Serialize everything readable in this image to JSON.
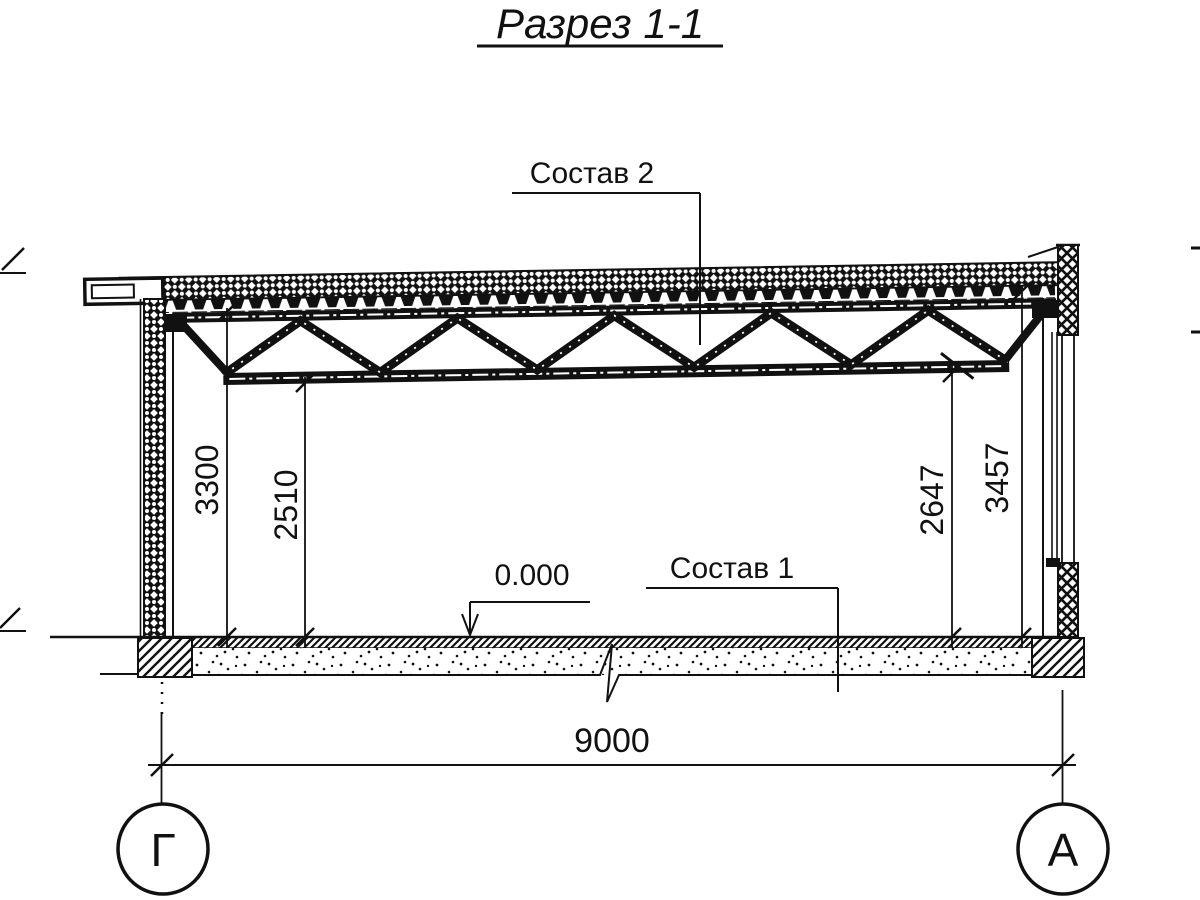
{
  "title": "Разрез 1-1",
  "colors": {
    "ink": "#111111",
    "background": "#ffffff"
  },
  "callouts": {
    "roof_assembly": "Состав 2",
    "floor_assembly": "Состав 1",
    "floor_level": "0.000"
  },
  "dimensions": {
    "left_outer": "3300",
    "left_inner": "2510",
    "right_inner": "2647",
    "right_outer": "3457",
    "span": "9000"
  },
  "axes": {
    "left": "Г",
    "right": "А"
  }
}
